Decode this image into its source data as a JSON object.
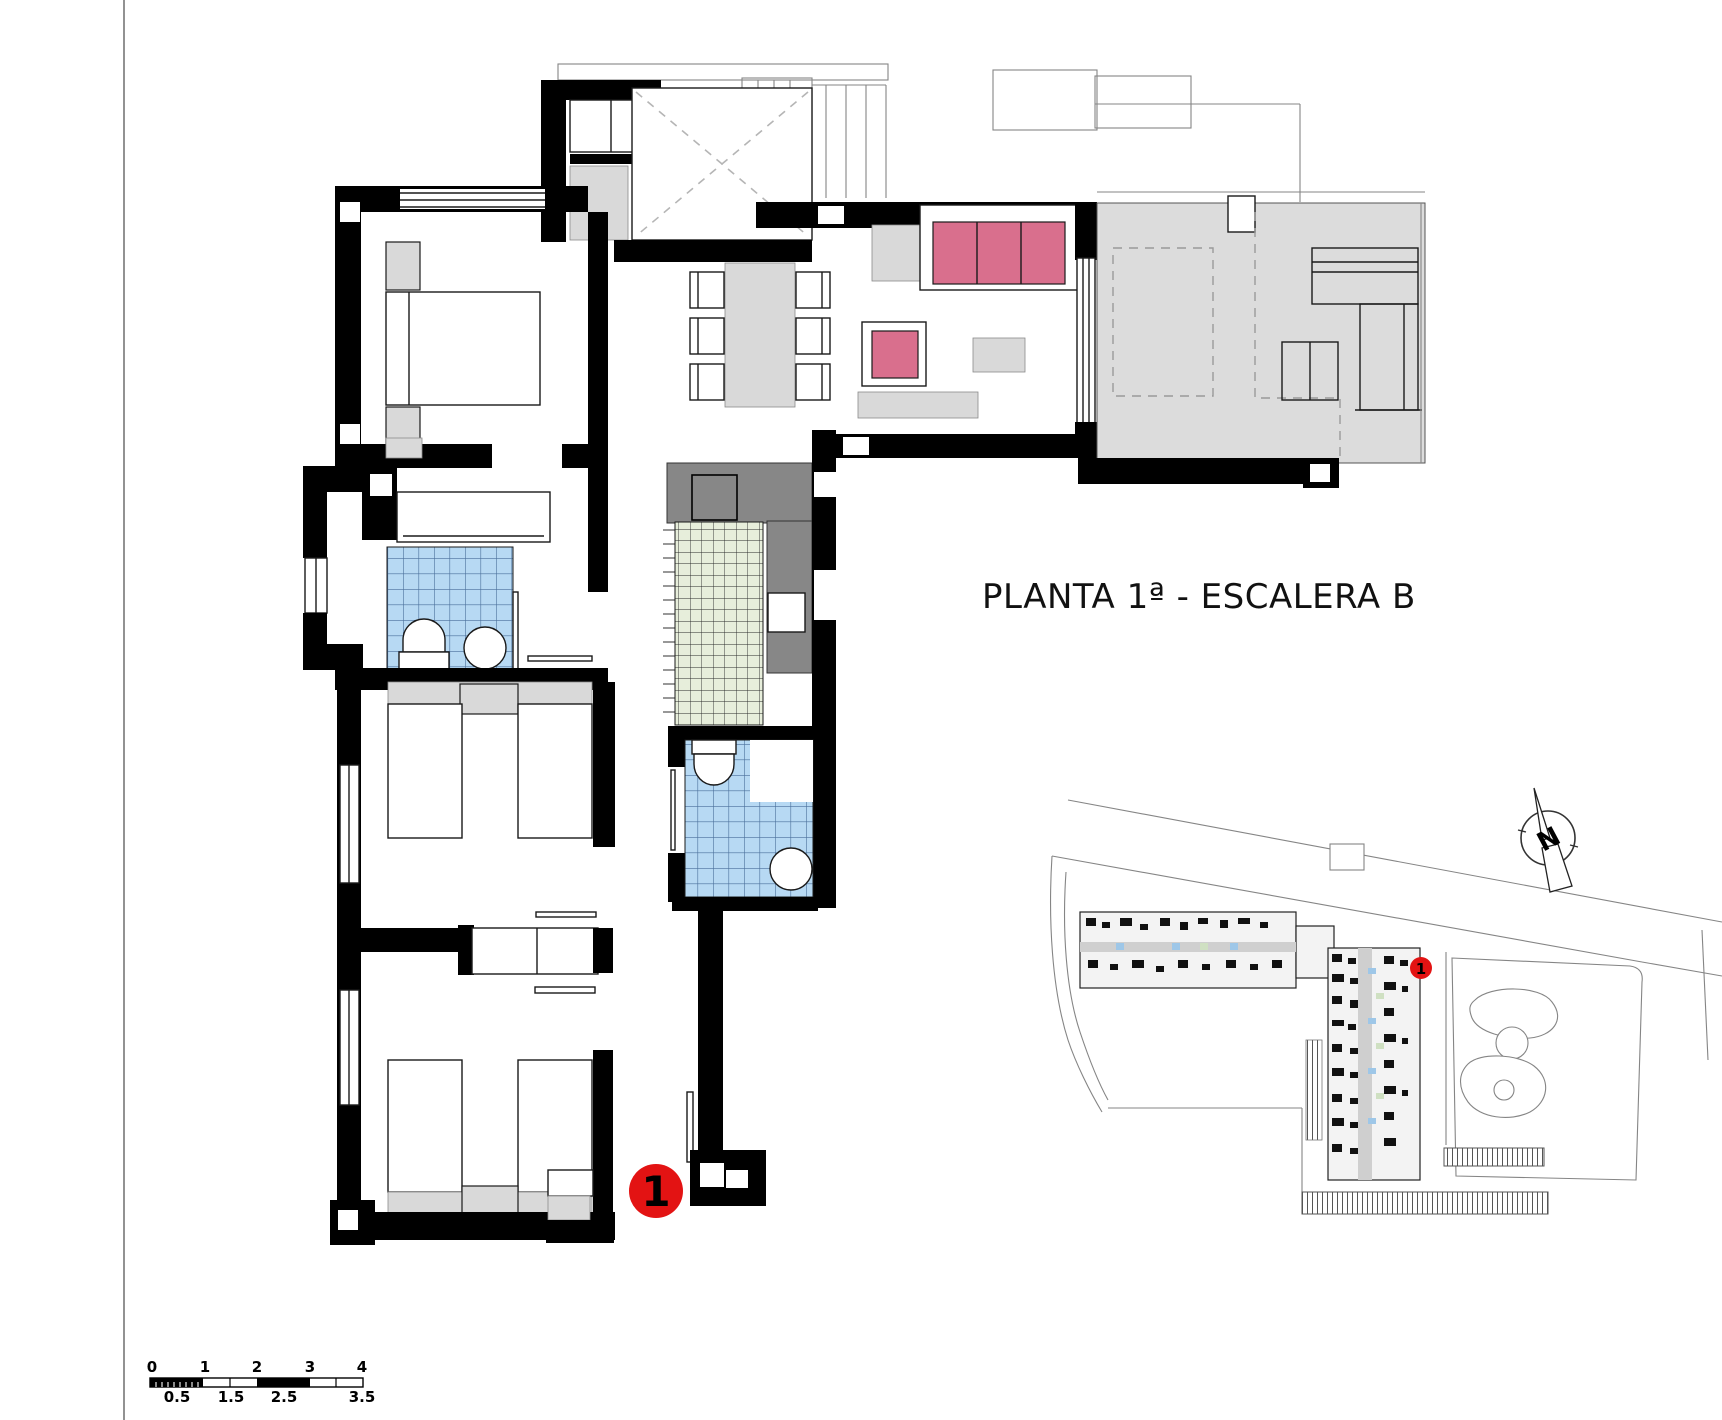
{
  "title": "PLANTA 1ª - ESCALERA B",
  "unit_marker": {
    "label": "1"
  },
  "site_plan": {
    "marker_label": "1",
    "north_label": "N"
  },
  "scale_bar": {
    "top_labels": [
      "0",
      "1",
      "2",
      "3",
      "4"
    ],
    "bottom_labels": [
      "0.5",
      "1.5",
      "2.5",
      "3.5"
    ]
  },
  "colors": {
    "wall": "#000000",
    "accent-red": "#e31313",
    "sofa-pink": "#d96f8d",
    "terrace-gray": "#dcdcdc",
    "furniture-gray": "#d9d9d9",
    "utility-gray": "#878787",
    "tile-blue": "#b7d9f3",
    "tile-blue-line": "#4a6f9b",
    "tile-green": "#e7eedb",
    "line-gray": "#858585"
  }
}
